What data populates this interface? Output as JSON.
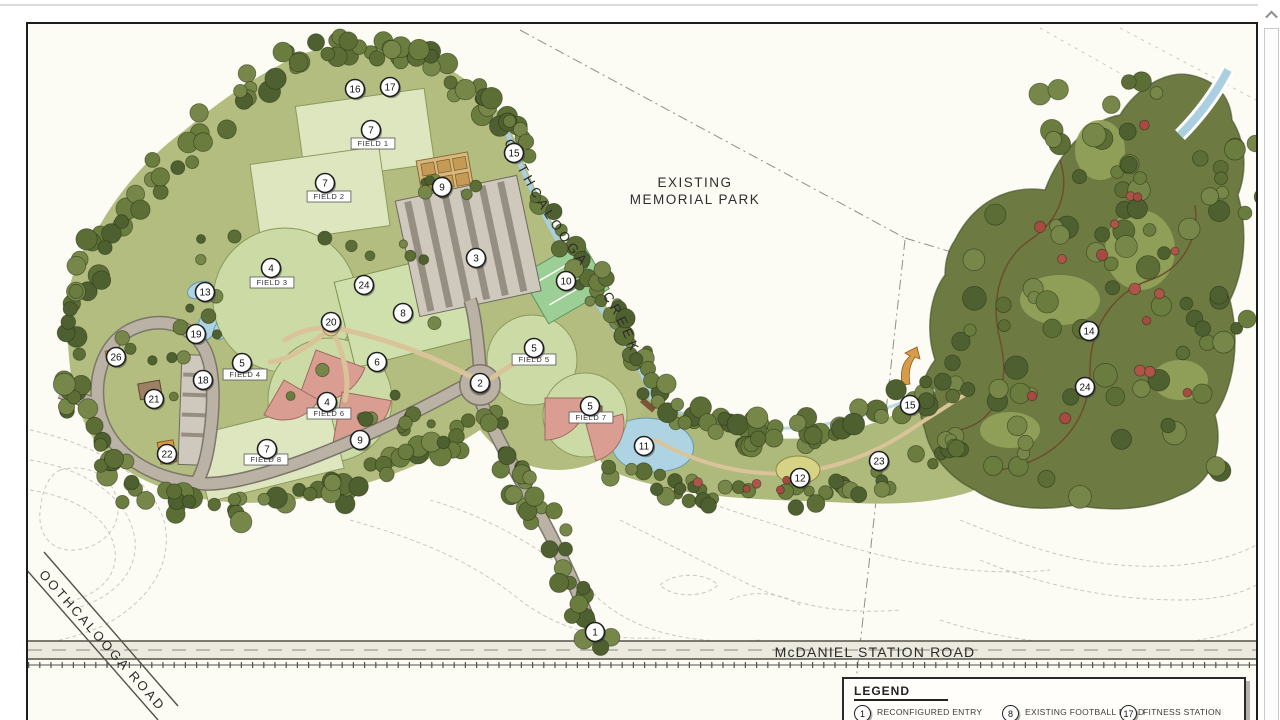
{
  "viewer": {
    "scrollbar": {
      "up_arrow_icon": "chevron-up"
    }
  },
  "plan": {
    "area_label": {
      "lines": [
        "EXISTING",
        "MEMORIAL PARK"
      ]
    },
    "creek_label": "OOTHCALOOGA CREEK",
    "road_labels": {
      "mcdaniel": "McDANIEL STATION ROAD",
      "oothcalooga": "OOTHCALOOGA ROAD"
    },
    "field_labels": [
      {
        "text": "FIELD 1",
        "x": 373,
        "y": 146
      },
      {
        "text": "FIELD 2",
        "x": 329,
        "y": 199
      },
      {
        "text": "FIELD 3",
        "x": 272,
        "y": 285
      },
      {
        "text": "FIELD 4",
        "x": 245,
        "y": 377
      },
      {
        "text": "FIELD 5",
        "x": 534,
        "y": 362
      },
      {
        "text": "FIELD 6",
        "x": 329,
        "y": 416
      },
      {
        "text": "FIELD 7",
        "x": 591,
        "y": 420
      },
      {
        "text": "FIELD 8",
        "x": 266,
        "y": 462
      }
    ],
    "markers": [
      {
        "n": "16",
        "x": 355,
        "y": 89
      },
      {
        "n": "17",
        "x": 390,
        "y": 87
      },
      {
        "n": "7",
        "x": 371,
        "y": 130
      },
      {
        "n": "15",
        "x": 514,
        "y": 153
      },
      {
        "n": "7",
        "x": 325,
        "y": 183
      },
      {
        "n": "9",
        "x": 442,
        "y": 187
      },
      {
        "n": "3",
        "x": 476,
        "y": 258
      },
      {
        "n": "4",
        "x": 271,
        "y": 268
      },
      {
        "n": "10",
        "x": 566,
        "y": 281
      },
      {
        "n": "24",
        "x": 364,
        "y": 285
      },
      {
        "n": "13",
        "x": 205,
        "y": 292
      },
      {
        "n": "8",
        "x": 403,
        "y": 313
      },
      {
        "n": "20",
        "x": 331,
        "y": 322
      },
      {
        "n": "19",
        "x": 196,
        "y": 334
      },
      {
        "n": "14",
        "x": 1089,
        "y": 331
      },
      {
        "n": "5",
        "x": 534,
        "y": 348
      },
      {
        "n": "26",
        "x": 116,
        "y": 357
      },
      {
        "n": "6",
        "x": 377,
        "y": 362
      },
      {
        "n": "5",
        "x": 242,
        "y": 363
      },
      {
        "n": "18",
        "x": 203,
        "y": 380
      },
      {
        "n": "2",
        "x": 480,
        "y": 383
      },
      {
        "n": "24",
        "x": 1085,
        "y": 387
      },
      {
        "n": "21",
        "x": 154,
        "y": 399
      },
      {
        "n": "4",
        "x": 327,
        "y": 402
      },
      {
        "n": "15",
        "x": 910,
        "y": 405
      },
      {
        "n": "5",
        "x": 590,
        "y": 406
      },
      {
        "n": "9",
        "x": 360,
        "y": 440
      },
      {
        "n": "11",
        "x": 644,
        "y": 446
      },
      {
        "n": "7",
        "x": 267,
        "y": 449
      },
      {
        "n": "22",
        "x": 167,
        "y": 454
      },
      {
        "n": "23",
        "x": 879,
        "y": 461
      },
      {
        "n": "12",
        "x": 800,
        "y": 478
      },
      {
        "n": "1",
        "x": 595,
        "y": 632
      }
    ],
    "legend": {
      "title": "LEGEND",
      "items": [
        {
          "num": "1",
          "lines": [
            "RECONFIGURED ENTRY",
            "- TRAFFIC SIGNAL",
            "- ONE LANE ENTRANCE"
          ]
        },
        {
          "num": "8",
          "lines": [
            "EXISTING FOOTBALL FIELD"
          ]
        },
        {
          "num": "17",
          "lines": [
            "FITNESS STATION"
          ]
        }
      ]
    },
    "colors": {
      "canopy": "#66743c",
      "forest_fill": "#6d7b42",
      "field_light": "#dde6bf",
      "grass_base": "#b3bd80",
      "infield_red": "#d99d92",
      "water": "#aed4e4",
      "road_gray": "#b9b2a5",
      "path_tan": "#d9c49a"
    }
  }
}
